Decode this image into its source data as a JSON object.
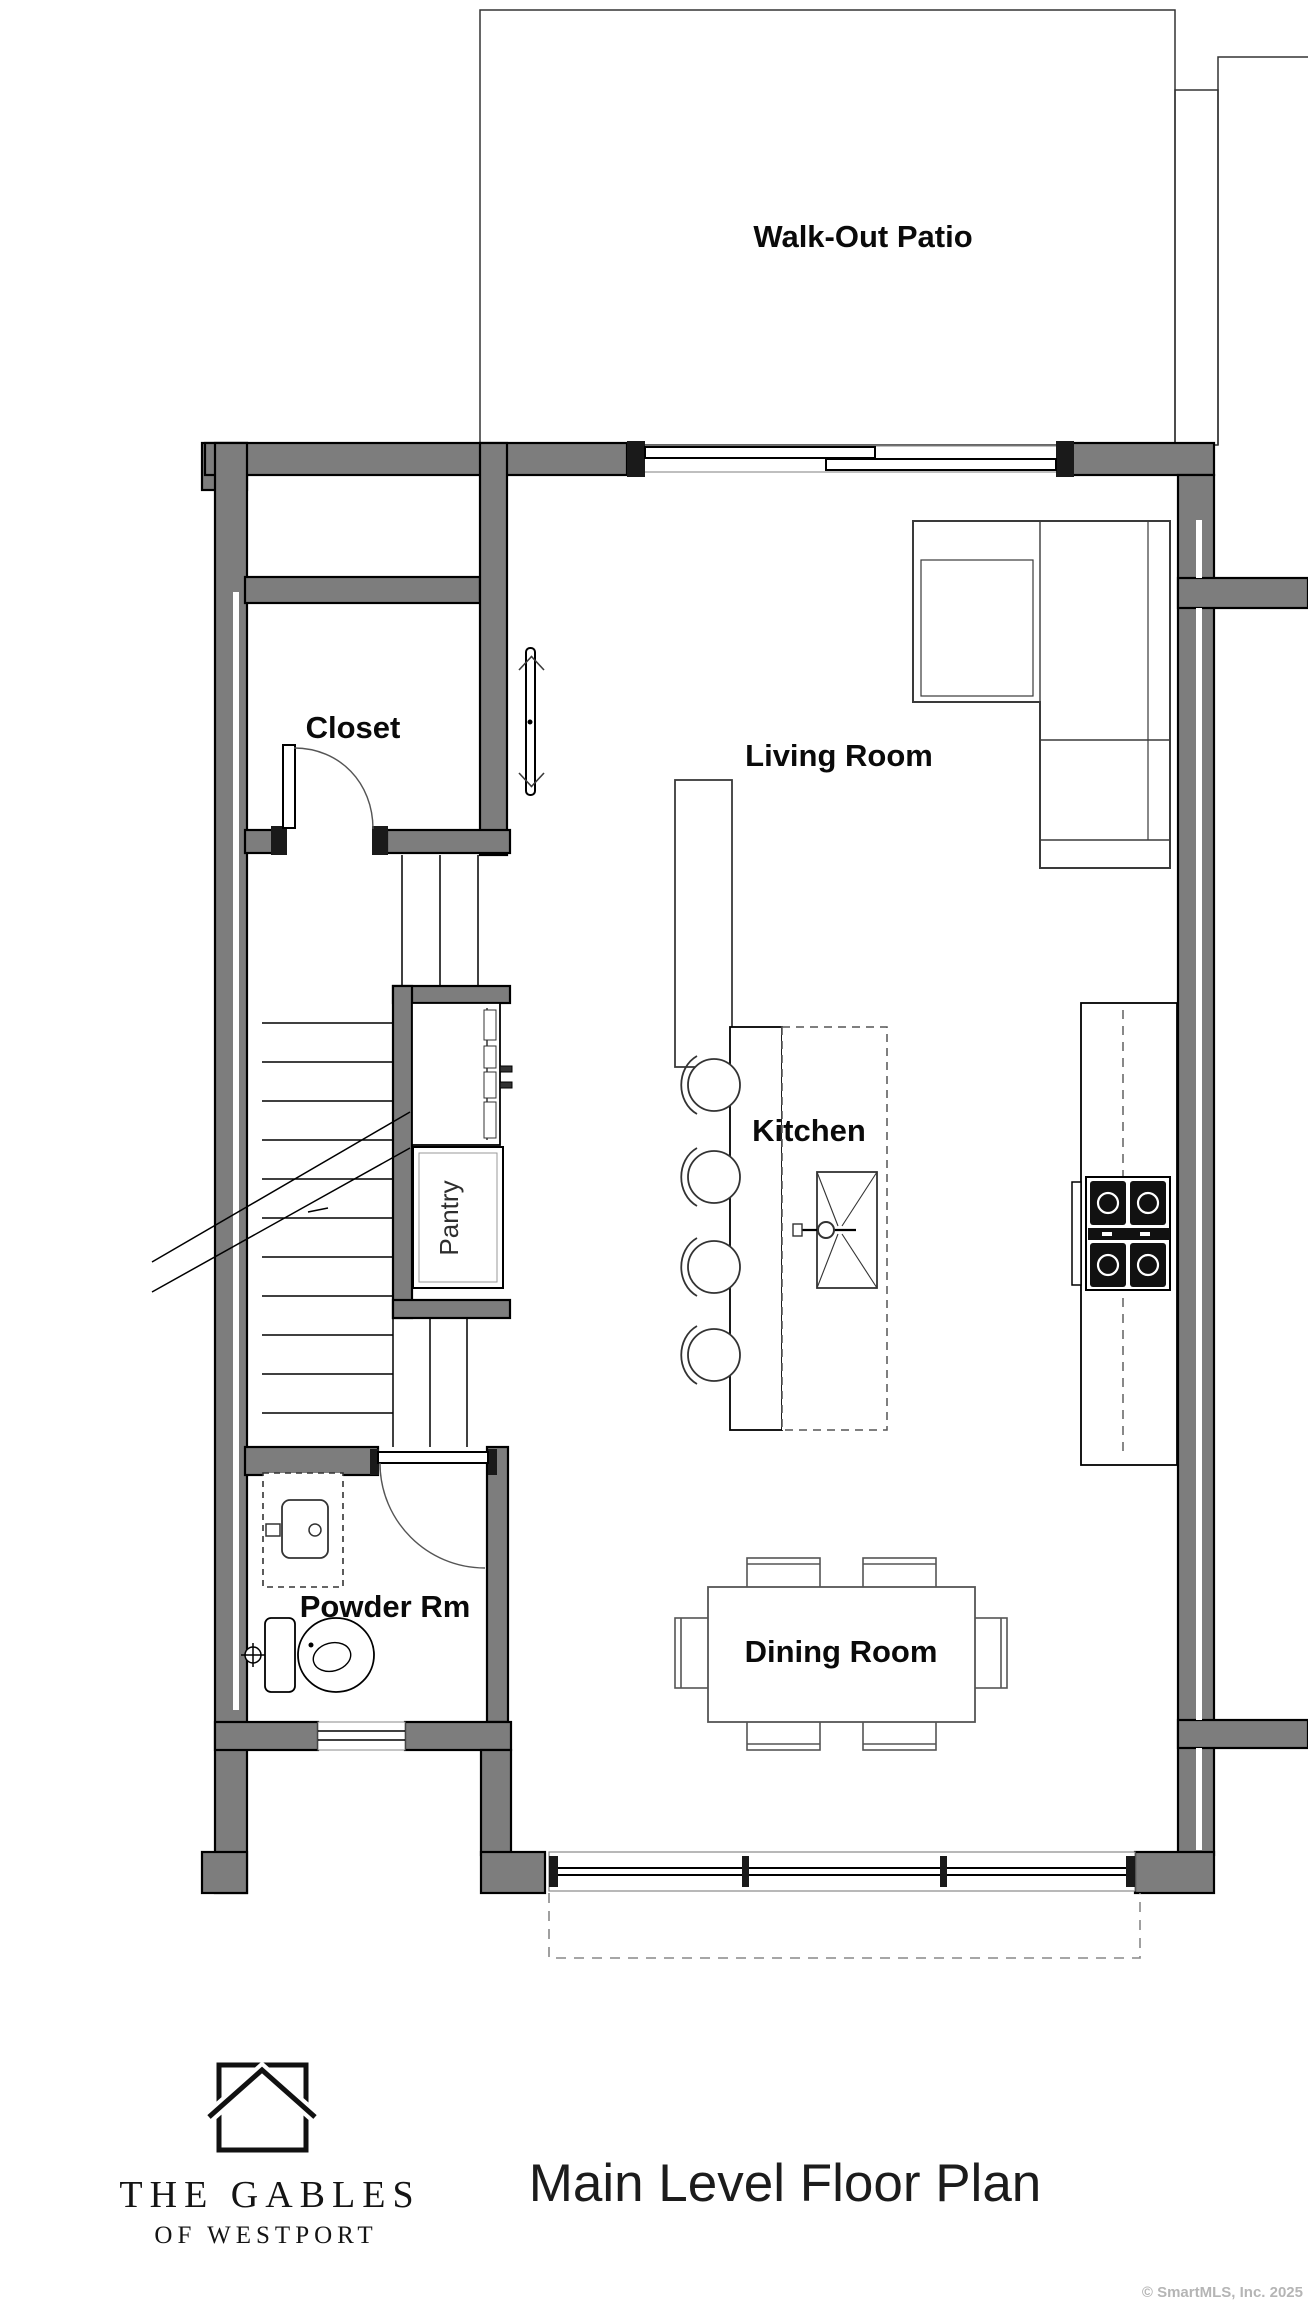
{
  "page": {
    "background": "#ffffff",
    "rooms": {
      "patio": "Walk-Out Patio",
      "living": "Living Room",
      "closet": "Closet",
      "kitchen": "Kitchen",
      "pantry": "Pantry",
      "powder": "Powder Rm",
      "dining": "Dining Room"
    },
    "footer": {
      "brand_name": "THE GABLES",
      "brand_tagline": "OF WESTPORT",
      "plan_title": "Main Level Floor Plan",
      "copyright": "© SmartMLS, Inc.  2025"
    },
    "colors": {
      "wall_fill": "#7d7d7d",
      "wall_outline": "#000000",
      "furniture_line": "#3a3a3a",
      "label_text": "#0a0a0a",
      "copyright_text": "#b5b5b5"
    }
  }
}
